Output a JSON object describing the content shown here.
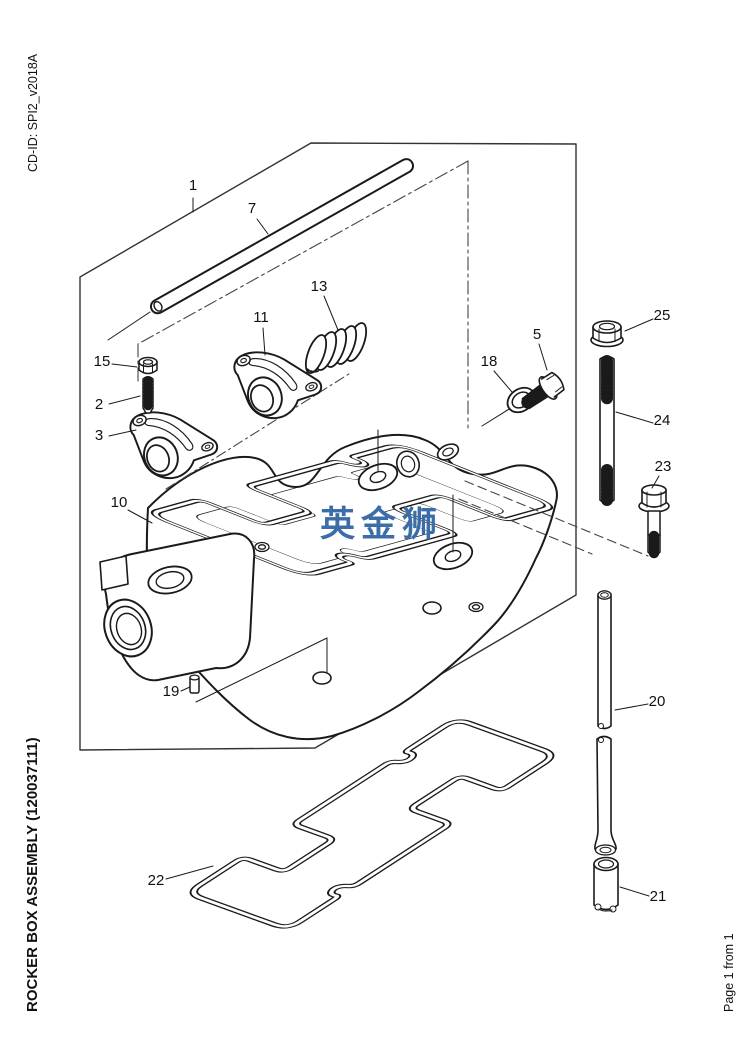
{
  "page": {
    "background": "#ffffff",
    "line_color": "#1a1a1a"
  },
  "margin_texts": {
    "cd_id": "CD-ID: SPI2_v2018A",
    "title": "ROCKER BOX ASSEMBLY (120037111)",
    "page_indicator": "Page 1 from 1"
  },
  "watermark": {
    "text": "英金狮",
    "color": "#3b6da9"
  },
  "diagram": {
    "callouts": {
      "n1": "1",
      "n2": "2",
      "n3": "3",
      "n5": "5",
      "n7": "7",
      "n10": "10",
      "n11": "11",
      "n13": "13",
      "n15": "15",
      "n18": "18",
      "n19": "19",
      "n20": "20",
      "n21": "21",
      "n22": "22",
      "n23": "23",
      "n24": "24",
      "n25": "25"
    }
  }
}
